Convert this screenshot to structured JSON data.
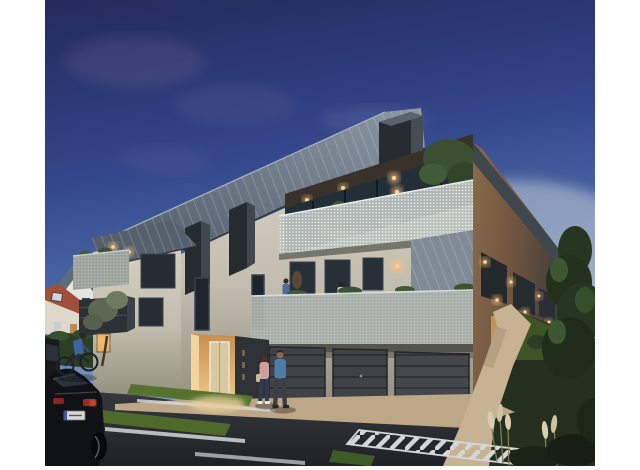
{
  "image": {
    "kind": "architectural-dusk-rendering",
    "subject": "modern three-storey apartment residence with zinc standing-seam roof, perforated mesh balconies, lit entrance lobby, garages, street parking, cyclist, two pedestrians, neighbouring pitched-roof houses and a landscaped garden",
    "time_of_day": "dusk",
    "frame_background": "#ffffff"
  },
  "scene": {
    "elements": [
      "dusk-sky",
      "purple-clouds",
      "zinc-roof",
      "dormer-fins",
      "attic-terrace",
      "terrace-tree",
      "mesh-balustrade",
      "first-floor-balcony",
      "balcony-figures",
      "garage-doors",
      "entrance-lobby",
      "address-panel",
      "tall-windows",
      "wall-sconces",
      "left-wing-balconies",
      "olive-tree",
      "neighbor-house-white-gable",
      "neighbor-house-red-roof",
      "garden-hedge",
      "street-asphalt",
      "parking-lines",
      "grass-strips",
      "chevron-hatching",
      "black-sedan",
      "cyclist",
      "pedestrian-woman",
      "pedestrian-man",
      "gravel-sidewalk",
      "garden-path",
      "conifer-tree",
      "pampas-grass",
      "wooden-fence"
    ]
  },
  "palette": {
    "sky_top": "#232a5c",
    "sky_mid": "#4a68a6",
    "sky_horizon": "#bac6d1",
    "cloud_purple": "#6a5d92",
    "roof_zinc_dark": "#4d5864",
    "roof_zinc_light": "#8c97a4",
    "fin_dark": "#262b30",
    "facade_cream": "#d7d2c2",
    "facade_shadow": "#93907f",
    "soffit_dark": "#38322b",
    "glass_dark": "#222e38",
    "mesh_light": "#b9c1bd",
    "mesh_dark": "#2c3136",
    "zinc_band": "#7f8a96",
    "garage_door": "#3f4347",
    "warm_light": "#ffc37a",
    "entrance_glow": "#ecc887",
    "asphalt_light": "#3d4147",
    "asphalt_dark": "#1f2126",
    "gravel": "#bda787",
    "path_beige": "#c7b294",
    "line_white": "#d3d7d8",
    "grass_green": "#55732f",
    "hedge_green": "#2b3f24",
    "garden_dark": "#24301d",
    "conifer_green": "#273620",
    "pampas_cream": "#d9cdb2",
    "red_roof": "#a14e3b",
    "white_wall": "#e6e4de",
    "gray_roof": "#626c79",
    "side_wall_warm": "#8a6a4c",
    "fence_wood": "#55412c",
    "car_black": "#101216",
    "taillight_red": "#ff6a4a",
    "denim_blue": "#4c7da9",
    "blouse_pink": "#cf9f9f",
    "cyclist_blue": "#3f62a0"
  }
}
